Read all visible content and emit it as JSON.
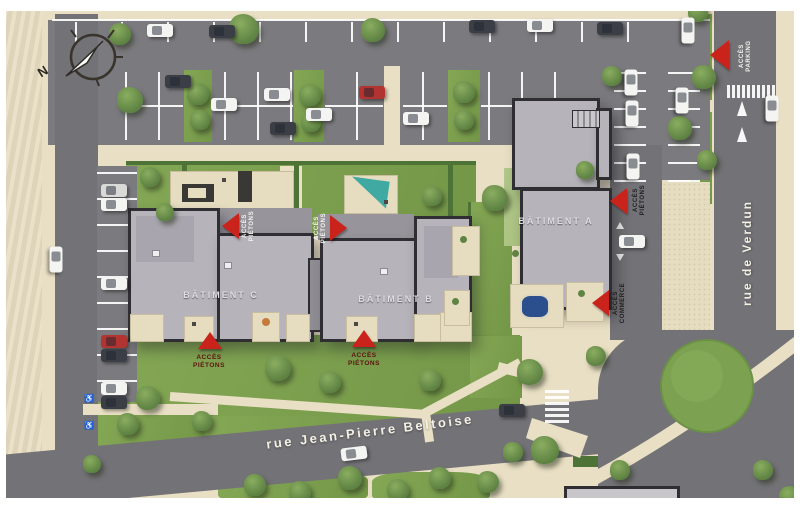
{
  "plan": {
    "compass_label": "N",
    "streets": {
      "bottom": "rue Jean-Pierre Beltoise",
      "right": "rue de Verdun"
    },
    "buildings": {
      "a": "BÂTIMENT A",
      "b": "BÂTIMENT B",
      "c": "BÂTIMENT C"
    },
    "access": {
      "pietons_nw": {
        "line1": "ACCÈS",
        "line2": "PIÉTONS"
      },
      "pietons_ne": {
        "line1": "ACCÈS",
        "line2": "PIÉTONS"
      },
      "pietons_sw": {
        "line1": "ACCÈS",
        "line2": "PIÉTONS"
      },
      "pietons_s": {
        "line1": "ACCÈS",
        "line2": "PIÉTONS"
      },
      "pietons_e": {
        "line1": "ACCÈS",
        "line2": "PIÉTONS"
      },
      "commerce": {
        "line1": "ACCÈS",
        "line2": "COMMERCE"
      },
      "parking": {
        "line1": "ACCÈS",
        "line2": "PARKING"
      }
    },
    "colors": {
      "access_red": "#c9231c",
      "road": "#737276",
      "parking_lot": "#7b7a7e",
      "sidewalk": "#e9dfc4",
      "grass": "#7fa050",
      "roof": "#b6b3ba",
      "roof_edge": "#2f2e32",
      "pool": "#2a4f8c",
      "canopy": "#3fa9a2",
      "car_white": "#f4f4f2",
      "car_dark": "#3b3f45",
      "car_red": "#b23430",
      "car_silver": "#d9d9d7",
      "line_white": "#ffffff"
    },
    "scene": {
      "trees": [
        [
          244,
          29,
          15
        ],
        [
          373,
          30,
          12
        ],
        [
          698,
          12,
          10
        ],
        [
          704,
          77,
          12
        ],
        [
          612,
          76,
          10
        ],
        [
          680,
          128,
          12
        ],
        [
          707,
          160,
          10
        ],
        [
          198,
          94,
          11
        ],
        [
          200,
          120,
          10
        ],
        [
          310,
          95,
          11
        ],
        [
          311,
          122,
          10
        ],
        [
          464,
          92,
          11
        ],
        [
          464,
          120,
          10
        ],
        [
          120,
          34,
          11
        ],
        [
          130,
          100,
          13
        ],
        [
          150,
          177,
          10
        ],
        [
          165,
          212,
          9
        ],
        [
          432,
          196,
          10
        ],
        [
          495,
          198,
          13
        ],
        [
          585,
          170,
          9
        ],
        [
          148,
          398,
          12
        ],
        [
          128,
          424,
          11
        ],
        [
          202,
          421,
          10
        ],
        [
          92,
          464,
          9
        ],
        [
          278,
          368,
          13
        ],
        [
          330,
          382,
          11
        ],
        [
          430,
          380,
          11
        ],
        [
          530,
          372,
          13
        ],
        [
          596,
          356,
          10
        ],
        [
          545,
          450,
          14
        ],
        [
          513,
          452,
          10
        ],
        [
          255,
          485,
          11
        ],
        [
          300,
          492,
          11
        ],
        [
          350,
          478,
          12
        ],
        [
          398,
          490,
          11
        ],
        [
          440,
          478,
          11
        ],
        [
          488,
          482,
          11
        ],
        [
          620,
          470,
          10
        ],
        [
          763,
          470,
          10
        ],
        [
          790,
          497,
          11
        ]
      ],
      "cars": [
        [
          160,
          30,
          0,
          "white"
        ],
        [
          222,
          31,
          0,
          "dark"
        ],
        [
          482,
          26,
          0,
          "dark"
        ],
        [
          540,
          25,
          0,
          "white"
        ],
        [
          610,
          28,
          0,
          "dark"
        ],
        [
          178,
          81,
          0,
          "dark"
        ],
        [
          224,
          104,
          0,
          "white"
        ],
        [
          277,
          94,
          0,
          "white"
        ],
        [
          283,
          128,
          0,
          "dark"
        ],
        [
          319,
          114,
          0,
          "white"
        ],
        [
          372,
          92,
          0,
          "red"
        ],
        [
          416,
          118,
          0,
          "white"
        ],
        [
          114,
          190,
          0,
          "silver"
        ],
        [
          114,
          204,
          0,
          "white"
        ],
        [
          114,
          283,
          0,
          "white"
        ],
        [
          114,
          341,
          0,
          "red"
        ],
        [
          114,
          355,
          0,
          "dark"
        ],
        [
          114,
          388,
          0,
          "white"
        ],
        [
          114,
          402,
          0,
          "dark"
        ],
        [
          56,
          259,
          90,
          "white"
        ],
        [
          631,
          82,
          90,
          "white"
        ],
        [
          632,
          113,
          90,
          "white"
        ],
        [
          633,
          166,
          90,
          "white"
        ],
        [
          682,
          100,
          90,
          "white"
        ],
        [
          688,
          30,
          90,
          "white"
        ],
        [
          632,
          241,
          0,
          "white"
        ],
        [
          772,
          108,
          90,
          "white"
        ],
        [
          354,
          453,
          -7,
          "white"
        ],
        [
          512,
          410,
          0,
          "dark"
        ]
      ]
    }
  }
}
